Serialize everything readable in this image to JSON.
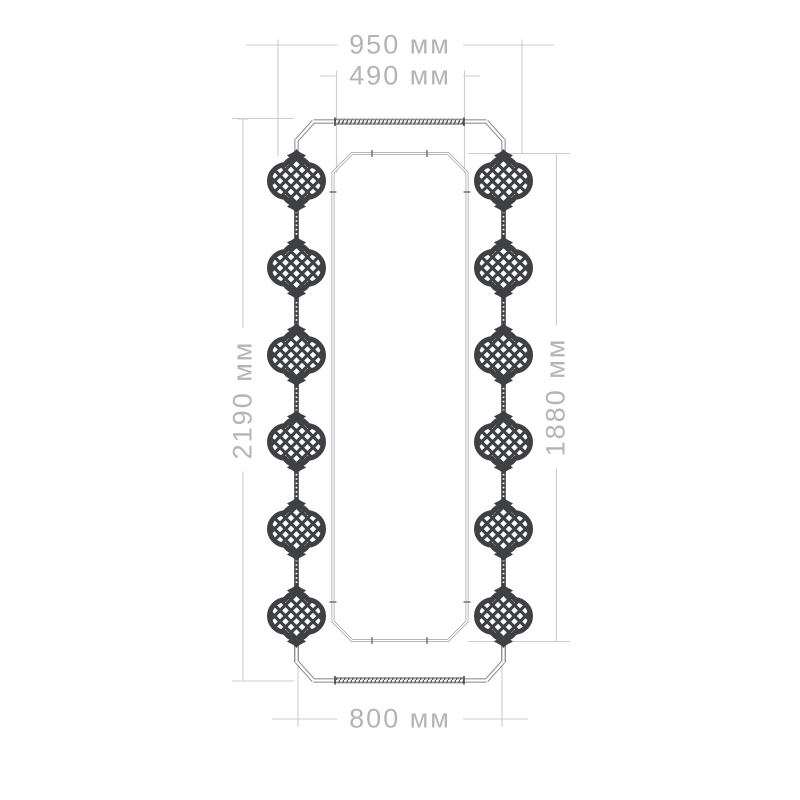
{
  "diagram": {
    "kind": "product dimension drawing",
    "subject": "tall mirror frame with moroccan lattice medallions",
    "units": "мм",
    "dimensions": {
      "top_outer_width": {
        "label": "950 мм",
        "value": 950
      },
      "top_inner_width": {
        "label": "490 мм",
        "value": 490
      },
      "left_overall_height": {
        "label": "2190 мм",
        "value": 2190
      },
      "right_inner_height": {
        "label": "1880 мм",
        "value": 1880
      },
      "bottom_width": {
        "label": "800 мм",
        "value": 800
      }
    },
    "ornaments": {
      "per_side": 6,
      "style": "moroccan-lantern-medallion with diamond lattice"
    },
    "colors": {
      "background": "#ffffff",
      "dimension_line": "#cbcecf",
      "dimension_text": "#b2b5b7",
      "frame_line": "#8f9294",
      "hatch": "#4e5053",
      "ornament": "#3e4043"
    }
  }
}
